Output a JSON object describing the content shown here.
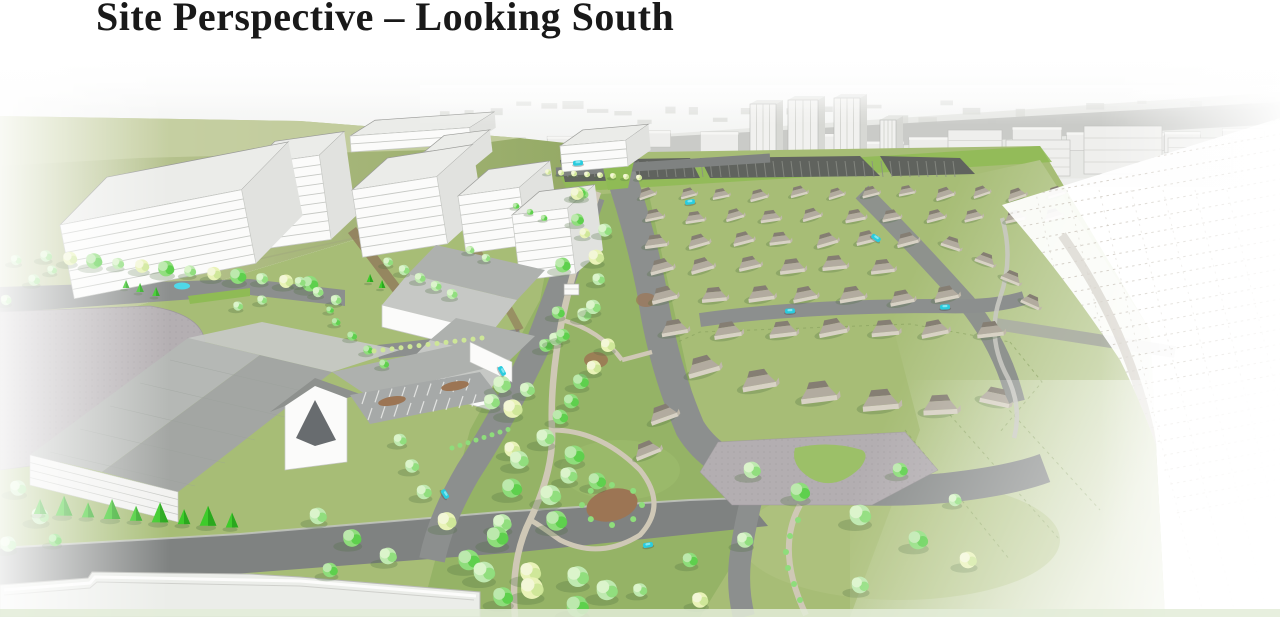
{
  "slide": {
    "title": "Site Perspective – Looking South"
  },
  "scene": {
    "type": "3d-site-massing-rendering",
    "view_direction": "south",
    "features": [
      "sky",
      "distant-city-skyline",
      "hillside",
      "midrise-buildings",
      "linear-greenway-park",
      "residential-neighborhood",
      "foreground-civic-building",
      "surface-roads",
      "parking-lots",
      "cars",
      "pond",
      "unbuilt-sketch-parcels"
    ]
  },
  "palette": {
    "title_text": "#191919",
    "page_bg": "#ffffff",
    "sky_top": "#fefefe",
    "sky_bottom": "#edeeec",
    "horizon_band": "#e7e8e5",
    "band_road": "#c6c8c4",
    "hill_light": "#c6cfa4",
    "hill_dark": "#8fa65f",
    "grass": "#a7bd76",
    "grass_bright": "#8fbb55",
    "grass_dark": "#93b165",
    "grass_pale": "#ccd8a8",
    "road": "#8c8f8e",
    "road_dark": "#7f8281",
    "curb": "#c6c8c4",
    "path": "#cfc8b6",
    "plaza": "#b3aeb1",
    "parking": "#a6a9a8",
    "parking_dark": "#60635e",
    "building_white": "#fbfbfa",
    "building_shade": "#e1e2df",
    "building_line": "#c7c9c5",
    "roof_flat": "#ebece9",
    "roof_pitch": "#aeb1ae",
    "roof_pitch_dark": "#9b9e9b",
    "roof_pitch_light": "#c6c8c5",
    "window_dark": "#4e5256",
    "house_wall": "#d8d2c5",
    "house_wall_dark": "#bfb8aa",
    "house_roof": "#b2ab9f",
    "house_roof_dark": "#857e73",
    "tree_mint": "#bfe9b0",
    "tree_mid": "#8edd7b",
    "tree_dark": "#5ccf4b",
    "tree_pale": "#e9f3b7",
    "tree_pale_mid": "#cde697",
    "tree_pale_hi": "#f3f7d8",
    "tree_bright": "#49d635",
    "tree_hi": "#dcf4cc",
    "evergreen": "#3ecb2b",
    "evergreen_dark": "#2aa81e",
    "shadow": "#4f6f3f",
    "car": "#2accde",
    "car_hi": "#8ceaf4",
    "pond": "#4fd8e8",
    "mulch": "#9c7554",
    "sketch_line": "#c8c2b8"
  }
}
